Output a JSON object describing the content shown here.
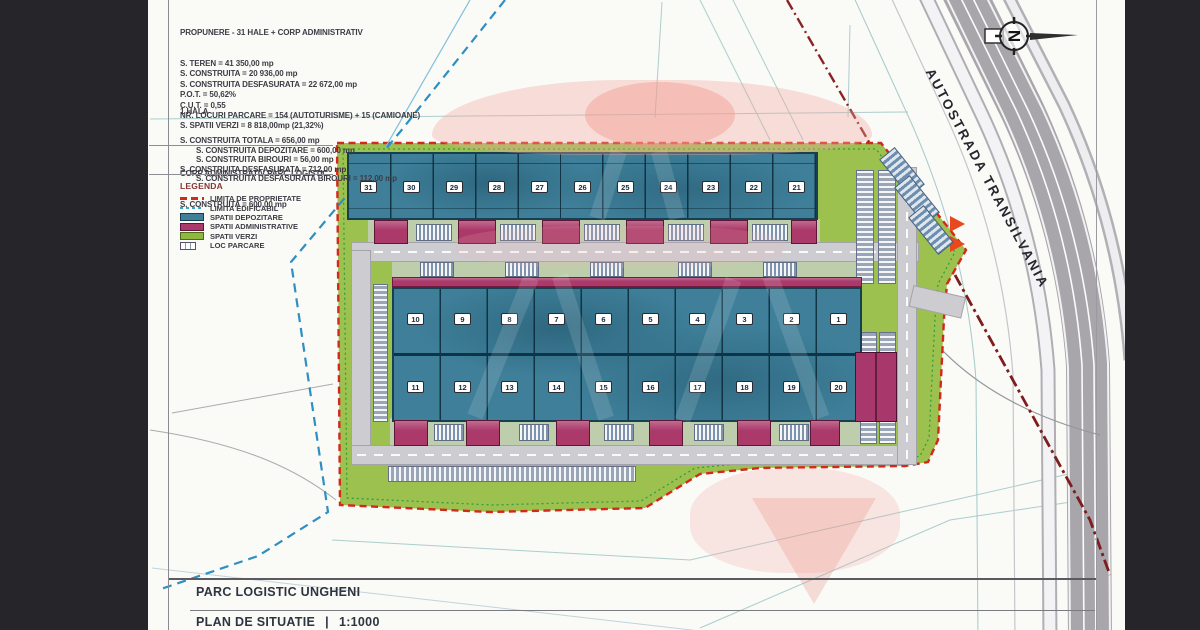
{
  "sheet": {
    "title": "PARC LOGISTIC UNGHENI",
    "plan_label": "PLAN DE SITUATIE",
    "separator": "|",
    "scale": "1:1000"
  },
  "proposal_block": {
    "title": "PROPUNERE - 31 HALE + CORP ADMINISTRATIV",
    "lines": [
      "S. TEREN = 41 350,00 mp",
      "S. CONSTRUITA = 20 936,00 mp",
      "S. CONSTRUITA DESFASURATA = 22 672,00 mp",
      "P.O.T. = 50,62%",
      "C.U.T. = 0,55",
      "NR. LOCURI PARCARE = 154 (AUTOTURISME) + 15 (CAMIOANE)",
      "S. SPATII VERZI = 8 818,00mp (21,32%)"
    ]
  },
  "hall_block": {
    "title": "1 HALA",
    "lines": [
      {
        "text": "S. CONSTRUITA TOTALA = 656,00 mp",
        "indent": 0
      },
      {
        "text": "S. CONSTRUITA DEPOZITARE = 600,00 mp",
        "indent": 1
      },
      {
        "text": "S. CONSTRUITA BIROURI = 56,00 mp",
        "indent": 1
      },
      {
        "text": "S. CONSTRUITA DESFASURATA = 712,00 mp",
        "indent": 0
      },
      {
        "text": "S. CONSTRUITA DESFASURATA BIROURI = 112,00 mp",
        "indent": 1
      }
    ]
  },
  "admin_block": {
    "title": "CORP ADMINISTRATIV PARC LOGISTIC",
    "lines": [
      "S. CONSTRUITA = 600,00 mp"
    ]
  },
  "legend": {
    "title": "LEGENDA",
    "items": [
      {
        "swatch": "red-dash",
        "label": "LIMITA DE PROPRIETATE"
      },
      {
        "swatch": "blue-dot",
        "label": "LIMITA EDIFICABIL"
      },
      {
        "swatch": "teal",
        "label": "SPATII DEPOZITARE"
      },
      {
        "swatch": "magenta",
        "label": "SPATII ADMINISTRATIVE"
      },
      {
        "swatch": "green",
        "label": "SPATII VERZI"
      },
      {
        "swatch": "parking",
        "label": "LOC PARCARE"
      }
    ]
  },
  "highway": {
    "label": "AUTOSTRADA TRANSILVANIA"
  },
  "compass": {
    "label": "N"
  },
  "site": {
    "rows": {
      "top": [
        "31",
        "30",
        "29",
        "28",
        "27",
        "26",
        "25",
        "24",
        "23",
        "22",
        "21"
      ],
      "middle": [
        "10",
        "9",
        "8",
        "7",
        "6",
        "5",
        "4",
        "3",
        "2",
        "1"
      ],
      "bottom": [
        "11",
        "12",
        "13",
        "14",
        "15",
        "16",
        "17",
        "18",
        "19",
        "20"
      ]
    }
  },
  "colors": {
    "storage_teal": "#3f7f99",
    "admin_magenta": "#ab3a6b",
    "green_space": "#9cc14f",
    "property_boundary_red": "#d3281c",
    "buildable_limit_blue": "#2e8fc2",
    "road_gray": "#cdccd1",
    "highway_gray": "#a8a5ab"
  }
}
